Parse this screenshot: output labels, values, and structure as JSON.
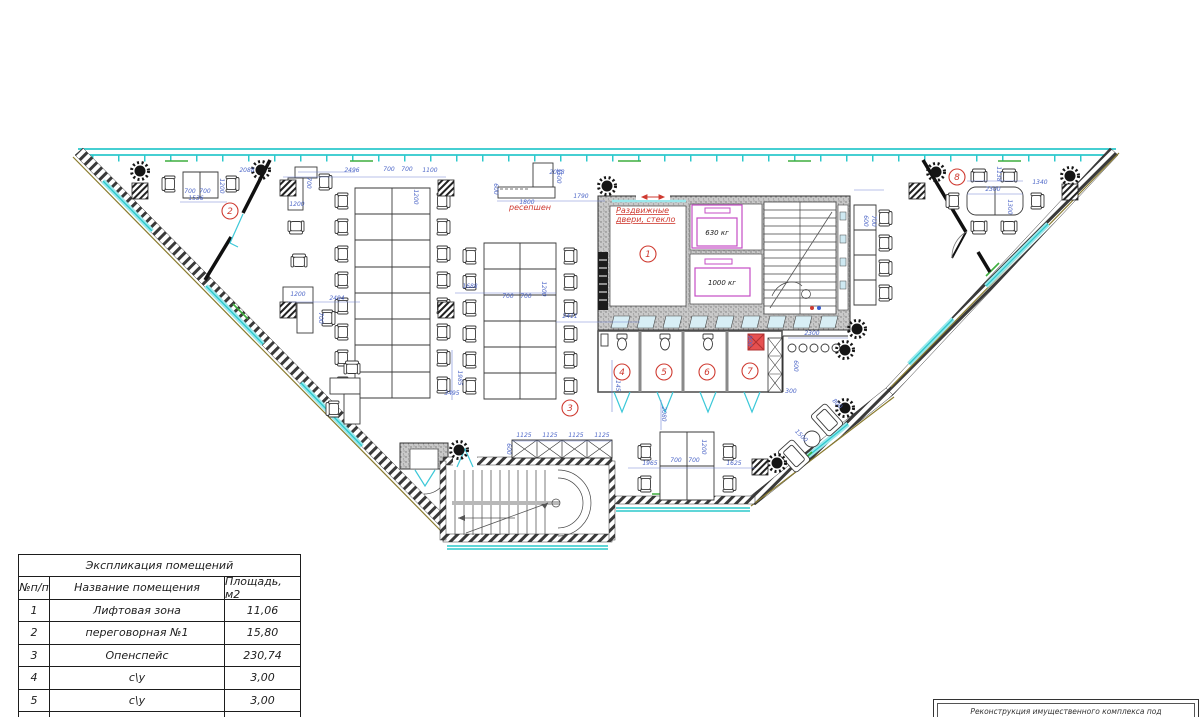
{
  "plan": {
    "annotations": {
      "reception": "ресепшен",
      "sliding_doors_l1": "Раздвижные",
      "sliding_doors_l2": "двери, стекло",
      "elevator_small": "630 кг",
      "elevator_large": "1000 кг"
    },
    "room_bubbles": [
      {
        "n": "1",
        "x": 648,
        "y": 254
      },
      {
        "n": "2",
        "x": 230,
        "y": 211
      },
      {
        "n": "3",
        "x": 570,
        "y": 408
      },
      {
        "n": "4",
        "x": 622,
        "y": 372
      },
      {
        "n": "5",
        "x": 664,
        "y": 372
      },
      {
        "n": "6",
        "x": 707,
        "y": 372
      },
      {
        "n": "7",
        "x": 750,
        "y": 371
      },
      {
        "n": "8",
        "x": 957,
        "y": 177
      }
    ],
    "dim_labels": [
      {
        "t": "2088",
        "x": 247,
        "y": 172
      },
      {
        "t": "1536",
        "x": 196,
        "y": 200
      },
      {
        "t": "700",
        "x": 190,
        "y": 193
      },
      {
        "t": "700",
        "x": 205,
        "y": 193
      },
      {
        "t": "1200",
        "x": 220,
        "y": 186,
        "r": 90
      },
      {
        "t": "2496",
        "x": 352,
        "y": 172
      },
      {
        "t": "700",
        "x": 389,
        "y": 171
      },
      {
        "t": "700",
        "x": 407,
        "y": 171
      },
      {
        "t": "1100",
        "x": 430,
        "y": 172
      },
      {
        "t": "1200",
        "x": 414,
        "y": 197,
        "r": 90
      },
      {
        "t": "1200",
        "x": 297,
        "y": 206
      },
      {
        "t": "700",
        "x": 307,
        "y": 183,
        "r": 90
      },
      {
        "t": "2494",
        "x": 337,
        "y": 300
      },
      {
        "t": "1200",
        "x": 298,
        "y": 296
      },
      {
        "t": "700",
        "x": 319,
        "y": 318,
        "r": 90
      },
      {
        "t": "1800",
        "x": 527,
        "y": 204
      },
      {
        "t": "600",
        "x": 494,
        "y": 189,
        "r": 90
      },
      {
        "t": "1500",
        "x": 557,
        "y": 176,
        "r": 90
      },
      {
        "t": "1790",
        "x": 581,
        "y": 198
      },
      {
        "t": "2068",
        "x": 557,
        "y": 174
      },
      {
        "t": "1688",
        "x": 470,
        "y": 288
      },
      {
        "t": "700",
        "x": 508,
        "y": 298
      },
      {
        "t": "700",
        "x": 526,
        "y": 298
      },
      {
        "t": "1200",
        "x": 542,
        "y": 289,
        "r": 90
      },
      {
        "t": "2411",
        "x": 570,
        "y": 318
      },
      {
        "t": "3495",
        "x": 452,
        "y": 395
      },
      {
        "t": "1985",
        "x": 458,
        "y": 378,
        "r": 90
      },
      {
        "t": "2145",
        "x": 616,
        "y": 384,
        "r": 90
      },
      {
        "t": "2080",
        "x": 662,
        "y": 414,
        "r": 90
      },
      {
        "t": "1125",
        "x": 524,
        "y": 437
      },
      {
        "t": "1125",
        "x": 550,
        "y": 437
      },
      {
        "t": "1125",
        "x": 576,
        "y": 437
      },
      {
        "t": "1125",
        "x": 602,
        "y": 437
      },
      {
        "t": "600",
        "x": 507,
        "y": 449,
        "r": 90
      },
      {
        "t": "1965",
        "x": 650,
        "y": 465
      },
      {
        "t": "700",
        "x": 676,
        "y": 462
      },
      {
        "t": "700",
        "x": 694,
        "y": 462
      },
      {
        "t": "1625",
        "x": 734,
        "y": 465
      },
      {
        "t": "1200",
        "x": 702,
        "y": 447,
        "r": 90
      },
      {
        "t": "1138",
        "x": 997,
        "y": 174,
        "r": 90
      },
      {
        "t": "1340",
        "x": 1040,
        "y": 184
      },
      {
        "t": "2300",
        "x": 993,
        "y": 191
      },
      {
        "t": "1300",
        "x": 1008,
        "y": 207,
        "r": 90
      },
      {
        "t": "2300",
        "x": 812,
        "y": 335
      },
      {
        "t": "600",
        "x": 794,
        "y": 366,
        "r": 90
      },
      {
        "t": "300",
        "x": 791,
        "y": 393
      },
      {
        "t": "900",
        "x": 748,
        "y": 341,
        "r": 90
      },
      {
        "t": "800",
        "x": 836,
        "y": 405,
        "r": 45
      },
      {
        "t": "1500",
        "x": 800,
        "y": 437,
        "r": 45
      },
      {
        "t": "600",
        "x": 864,
        "y": 221,
        "r": 90
      },
      {
        "t": "700",
        "x": 872,
        "y": 221,
        "r": 90
      }
    ]
  },
  "legend_table": {
    "title": "Экспликация помещений",
    "headers": [
      "№п/п",
      "Название помещения",
      "Площадь, м2"
    ],
    "rows": [
      [
        "1",
        "Лифтовая зона",
        "11,06"
      ],
      [
        "2",
        "переговорная №1",
        "15,80"
      ],
      [
        "3",
        "Опенспейс",
        "230,74"
      ],
      [
        "4",
        "с\\у",
        "3,00"
      ],
      [
        "5",
        "с\\у",
        "3,00"
      ],
      [
        "6",
        "с\\у",
        "3,00"
      ]
    ]
  },
  "title_block": {
    "line1": "Реконструкция имущественного комплекса под"
  },
  "colors": {
    "glazing": "#2cc8cc",
    "dims": "#4f68c8",
    "red": "#cf3a30",
    "magenta": "#c54ec5",
    "green": "#3fae3f",
    "wall_gray": "#c9c9c9"
  }
}
